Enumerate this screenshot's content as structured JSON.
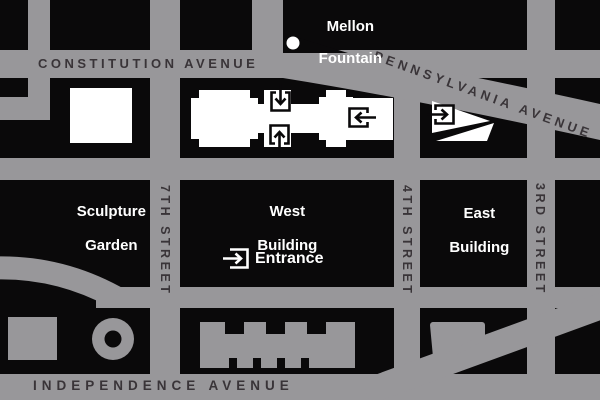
{
  "map": {
    "colors": {
      "street": "#98979A",
      "block": "#0A090A",
      "building_white": "#FFFFFF",
      "street_label": "#393438",
      "place_label": "#FFFFFF"
    },
    "avenues": {
      "constitution": "CONSTITUTION AVENUE",
      "pennsylvania": "PENNSYLVANIA AVENUE",
      "independence": "INDEPENDENCE AVENUE"
    },
    "streets": {
      "seventh": "7TH STREET",
      "fourth": "4TH STREET",
      "third": "3RD STREET"
    },
    "places": {
      "mellon_fountain": {
        "line1": "Mellon",
        "line2": "Fountain"
      },
      "sculpture_garden": {
        "line1": "Sculpture",
        "line2": "Garden"
      },
      "west_building": {
        "line1": "West",
        "line2": "Building"
      },
      "east_building": {
        "line1": "East",
        "line2": "Building"
      },
      "entrance": "Entrance"
    },
    "icons": {
      "west_north_entrance": "arrow-down-into-box-icon",
      "west_mall_entrance": "arrow-up-into-box-icon",
      "west_east_entrance": "arrow-left-into-box-icon",
      "east_building_entrance": "arrow-right-into-box-icon",
      "entrance_marker": "arrow-right-into-bracket-icon",
      "fountain_marker": "white-dot"
    }
  }
}
